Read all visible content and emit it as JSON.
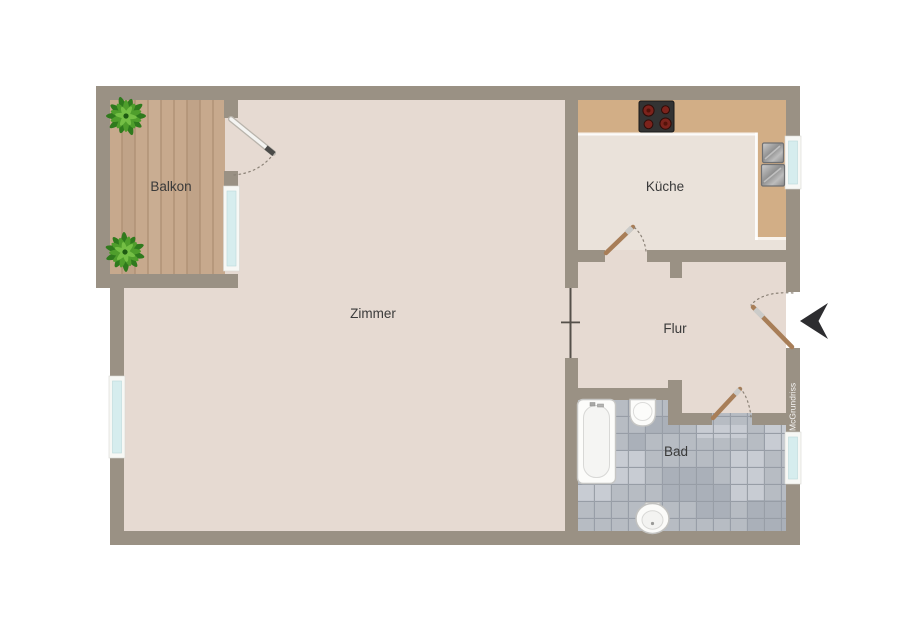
{
  "floorplan": {
    "rooms": {
      "balkon": "Balkon",
      "zimmer": "Zimmer",
      "kueche": "Küche",
      "flur": "Flur",
      "bad": "Bad"
    },
    "watermark": "McGrundriss"
  },
  "fixtures": [
    "stove-icon",
    "sink-icon",
    "bathtub-icon",
    "washbasin-icon",
    "toilet-icon",
    "plant-icon",
    "entrance-arrow-icon",
    "balcony-door",
    "kitchen-door",
    "entrance-door",
    "bathroom-door",
    "window",
    "wall-opening-marker"
  ],
  "palette": {
    "wall": "#9a9184",
    "wall_opening": "#55504a",
    "floor_main": "#e6dad2",
    "floor_kitchen": "#eae2da",
    "deck": "#c7a98d",
    "deck_line": "#ad8f74",
    "counter": "#d2ae86",
    "tile": "#b7bcc3",
    "tile_grout": "#979da6",
    "tile_light": "#c8ccd3",
    "tile_mid": "#aab0b9",
    "glass": "#d6edee",
    "frame": "#f7f8f5",
    "door_leaf": "#a87e58",
    "arc": "#8b8277",
    "arrow": "#2d2d30",
    "label": "#3a3a3a",
    "stove": "#333333",
    "burner": "#7c231c",
    "plant_dark": "#2f7a1d",
    "plant_mid": "#4f9e2c",
    "plant_light": "#74bf45"
  }
}
